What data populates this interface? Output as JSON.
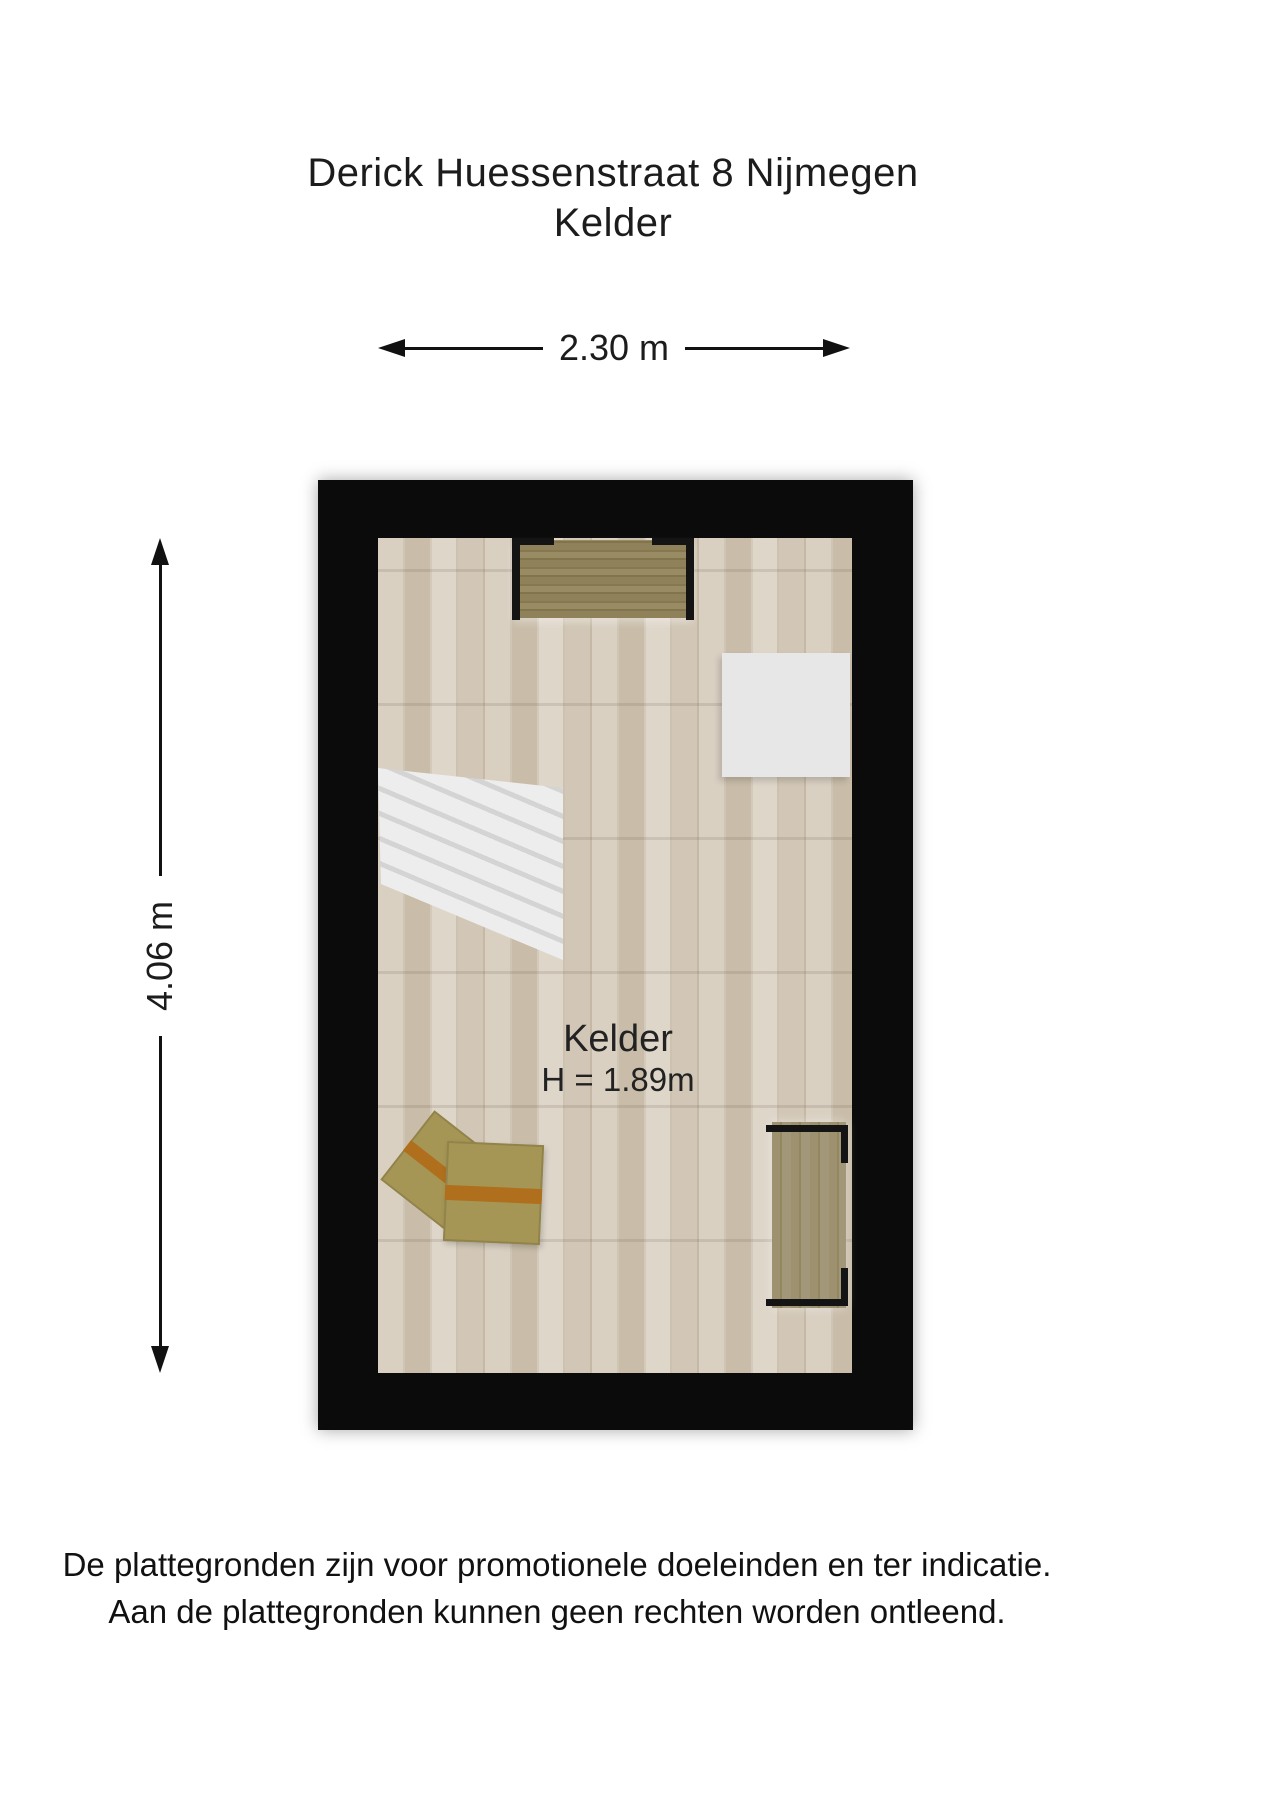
{
  "title": {
    "line1": "Derick Huessenstraat 8 Nijmegen",
    "line2": "Kelder"
  },
  "dimensions": {
    "width": {
      "label": "2.30 m"
    },
    "height": {
      "label": "4.06 m"
    }
  },
  "room": {
    "name": "Kelder",
    "ceiling_height": "H = 1.89m"
  },
  "footer": {
    "line1": "De plattegronden zijn voor promotionele doeleinden en ter indicatie.",
    "line2": "Aan de plattegronden kunnen geen rechten worden ontleend."
  },
  "furniture": {
    "workbench": "wall shelf with brackets",
    "white_board": "white panel",
    "staircase": "staircase with treads",
    "boxes": "two moving boxes with tape",
    "closet": "closet with open front"
  },
  "colors": {
    "wall": "#0b0b0b",
    "text": "#1c1c1c",
    "floor_base": "#d2c8b8",
    "furniture_wood": "#8b7d56",
    "cabinet_wood": "#9a8e6f",
    "box": "#a59655",
    "box_tape": "#b06f1c",
    "white_object": "#e7e7e7"
  }
}
